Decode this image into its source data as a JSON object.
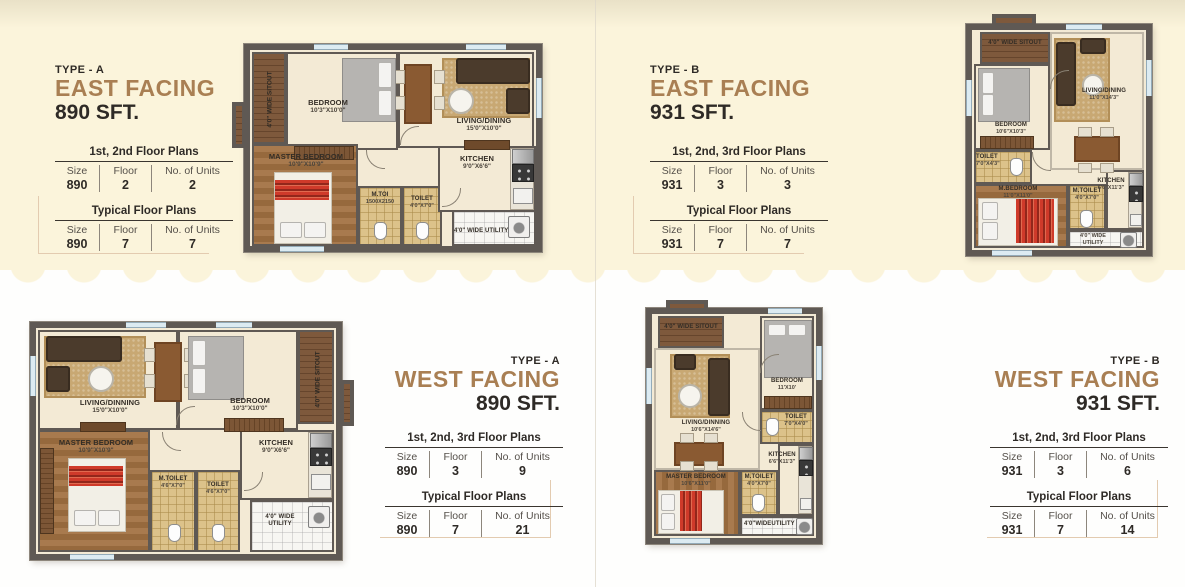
{
  "page": {
    "bg_top": "#FBF4DB",
    "bg_bottom": "#FFFFFF",
    "accent": "#A97F53",
    "ink": "#2E2A26"
  },
  "panels": [
    {
      "id": "east-a",
      "type_label": "TYPE - A",
      "facing": "EAST FACING",
      "size": "890 SFT.",
      "tables": [
        {
          "title": "1st, 2nd Floor Plans",
          "columns": [
            "Size",
            "Floor",
            "No. of Units"
          ],
          "values": [
            "890",
            "2",
            "2"
          ]
        },
        {
          "title": "Typical Floor Plans",
          "columns": [
            "Size",
            "Floor",
            "No. of Units"
          ],
          "values": [
            "890",
            "7",
            "7"
          ]
        }
      ]
    },
    {
      "id": "east-b",
      "type_label": "TYPE - B",
      "facing": "EAST FACING",
      "size": "931 SFT.",
      "tables": [
        {
          "title": "1st, 2nd, 3rd Floor Plans",
          "columns": [
            "Size",
            "Floor",
            "No. of Units"
          ],
          "values": [
            "931",
            "3",
            "3"
          ]
        },
        {
          "title": "Typical Floor Plans",
          "columns": [
            "Size",
            "Floor",
            "No. of Units"
          ],
          "values": [
            "931",
            "7",
            "7"
          ]
        }
      ]
    },
    {
      "id": "west-a",
      "type_label": "TYPE - A",
      "facing": "WEST FACING",
      "size": "890 SFT.",
      "tables": [
        {
          "title": "1st, 2nd, 3rd Floor Plans",
          "columns": [
            "Size",
            "Floor",
            "No. of Units"
          ],
          "values": [
            "890",
            "3",
            "9"
          ]
        },
        {
          "title": "Typical Floor Plans",
          "columns": [
            "Size",
            "Floor",
            "No. of Units"
          ],
          "values": [
            "890",
            "7",
            "21"
          ]
        }
      ]
    },
    {
      "id": "west-b",
      "type_label": "TYPE - B",
      "facing": "WEST FACING",
      "size": "931 SFT.",
      "tables": [
        {
          "title": "1st, 2nd, 3rd Floor Plans",
          "columns": [
            "Size",
            "Floor",
            "No. of Units"
          ],
          "values": [
            "931",
            "3",
            "6"
          ]
        },
        {
          "title": "Typical Floor Plans",
          "columns": [
            "Size",
            "Floor",
            "No. of Units"
          ],
          "values": [
            "931",
            "7",
            "14"
          ]
        }
      ]
    }
  ],
  "plans": {
    "east_a": {
      "sitout": "4'0\" WIDE SITOUT",
      "rooms": {
        "bedroom": {
          "name": "BEDROOM",
          "dim": "10'3\"X10'0\""
        },
        "living": {
          "name": "LIVING/DINING",
          "dim": "15'0\"X10'0\""
        },
        "master": {
          "name": "MASTER BEDROOM",
          "dim": "10'9\"X10'9\""
        },
        "mtoilet": {
          "name": "M.TOI",
          "dim": "1500X2150"
        },
        "toilet": {
          "name": "TOILET",
          "dim": "4'0\"X7'0\""
        },
        "kitchen": {
          "name": "KITCHEN",
          "dim": "9'0\"X6'6\""
        }
      },
      "utility": "4'0\" WIDE UTILITY"
    },
    "east_b": {
      "sitout": "4'0\" WIDE SITOUT",
      "rooms": {
        "bedroom": {
          "name": "BEDROOM",
          "dim": "10'6\"X10'3\""
        },
        "living": {
          "name": "LIVING/DINING",
          "dim": "11'0\"X14'3\""
        },
        "toilet": {
          "name": "TOILET",
          "dim": "7'0\"X4'3\""
        },
        "master": {
          "name": "M.BEDROOM",
          "dim": "11'0\"X11'0\""
        },
        "mtoilet": {
          "name": "M.TOILET",
          "dim": "4'0\"X7'0\""
        },
        "kitchen": {
          "name": "KITCHEN",
          "dim": "6'6\"X11'3\""
        }
      },
      "utility": "4'0\" WIDE UTILITY"
    },
    "west_a": {
      "sitout": "4'0\" WIDE SITOUT",
      "rooms": {
        "living": {
          "name": "LIVING/DINNING",
          "dim": "15'0\"X10'0\""
        },
        "bedroom": {
          "name": "BEDROOM",
          "dim": "10'3\"X10'0\""
        },
        "master": {
          "name": "MASTER BEDROOM",
          "dim": "10'9\"X10'9\""
        },
        "mtoilet": {
          "name": "M.TOILET",
          "dim": "4'6\"X7'0\""
        },
        "toilet": {
          "name": "TOILET",
          "dim": "4'6\"X7'0\""
        },
        "kitchen": {
          "name": "KITCHEN",
          "dim": "9'0\"X6'6\""
        }
      },
      "utility": "4'0\" WIDE UTILITY"
    },
    "west_b": {
      "sitout": "4'0\" WIDE SITOUT",
      "rooms": {
        "living": {
          "name": "LIVING/DINNING",
          "dim": "10'6\"X14'6\""
        },
        "bedroom": {
          "name": "BEDROOM",
          "dim": "11'X10'"
        },
        "toilet": {
          "name": "TOILET",
          "dim": "7'0\"X4'0\""
        },
        "master": {
          "name": "MASTER BEDROOM",
          "dim": "10'6\"X11'0\""
        },
        "mtoilet": {
          "name": "M.TOILET",
          "dim": "4'0\"X7'0\""
        },
        "kitchen": {
          "name": "KITCHEN",
          "dim": "6'6\"X11'3\""
        }
      },
      "utility": "4'0\"WIDEUTILITY"
    }
  }
}
